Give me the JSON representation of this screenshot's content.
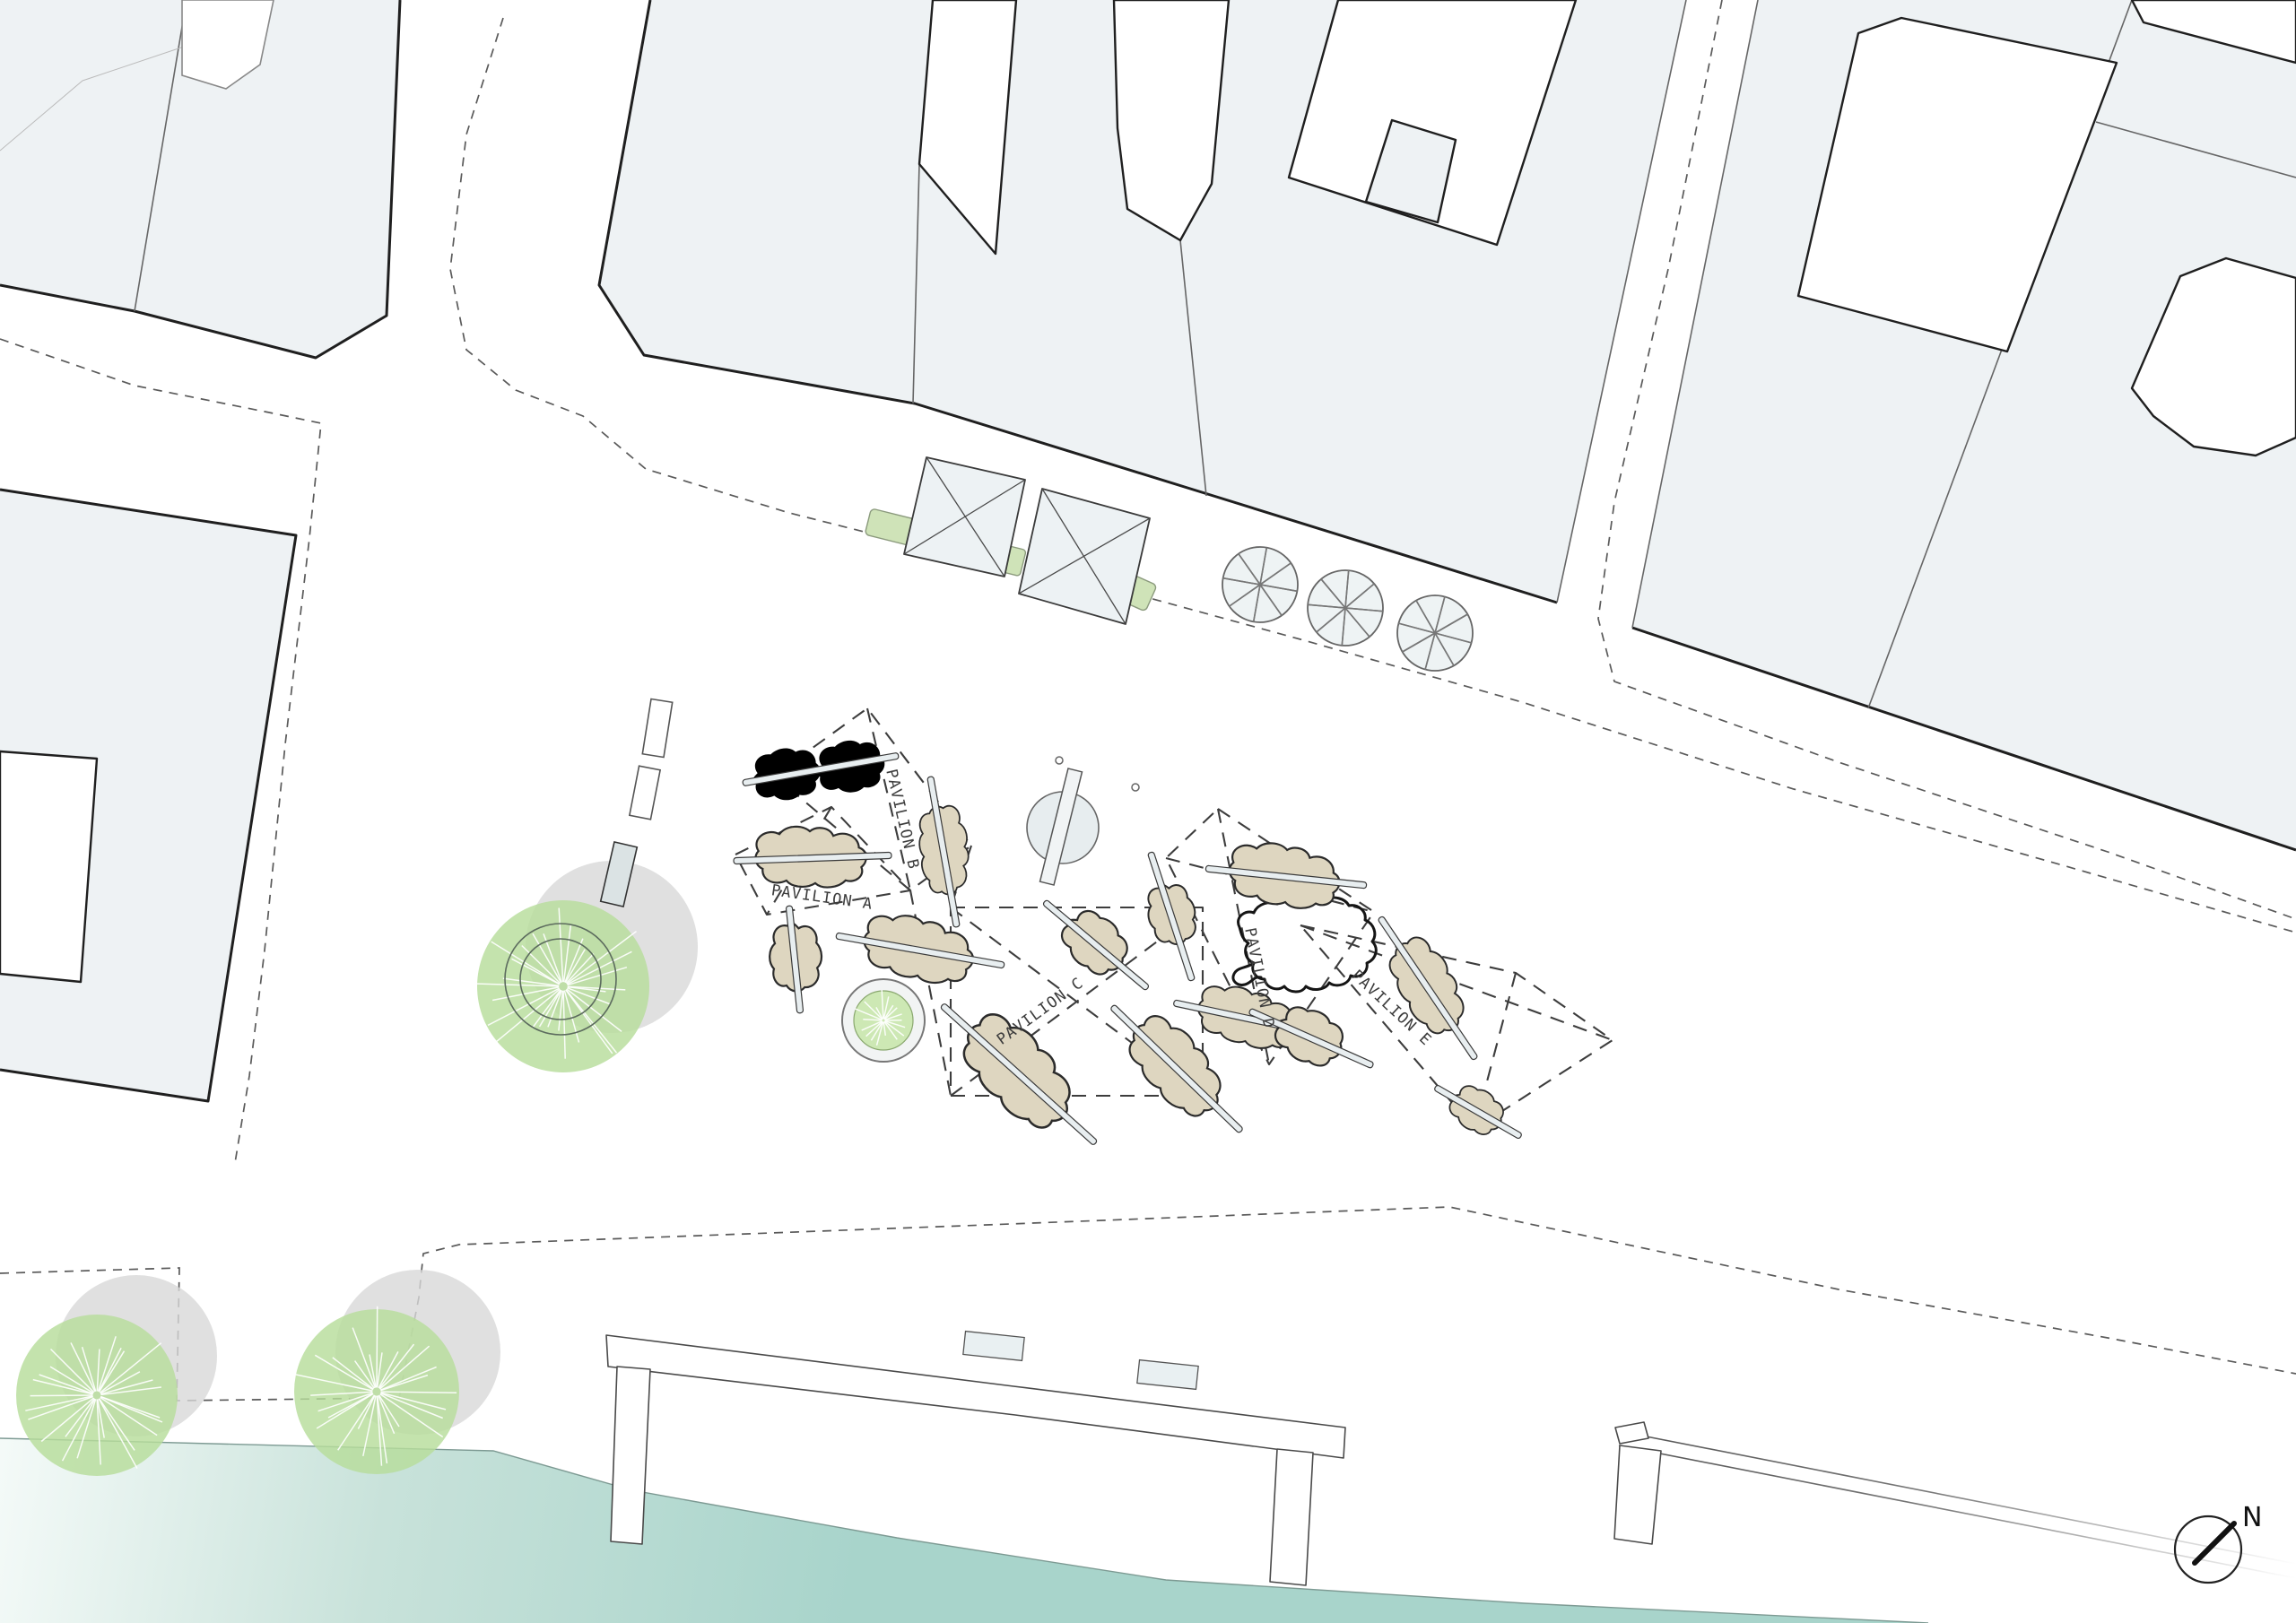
{
  "title": "Waterfront pavilion site plan",
  "pavilions": [
    {
      "label": "PAVILION A"
    },
    {
      "label": "PAVILION B"
    },
    {
      "label": "PAVILION C"
    },
    {
      "label": "PAVILION D"
    },
    {
      "label": "PAVILION E"
    }
  ],
  "compass": {
    "north_label": "N"
  },
  "colors": {
    "building_fill": "#eef2f4",
    "outline_ink": "#1f1f1f",
    "dashed_line": "#5a5a5a",
    "blob_tan": "#ded6c0",
    "bench_fill": "#e8eef0",
    "hedge_green": "#cfe3b8",
    "tree_green": "#b7dd9b",
    "shadow_gray": "#d8d8d8",
    "water_teal": "#a8d4cb",
    "water_light": "#f4faf8"
  }
}
